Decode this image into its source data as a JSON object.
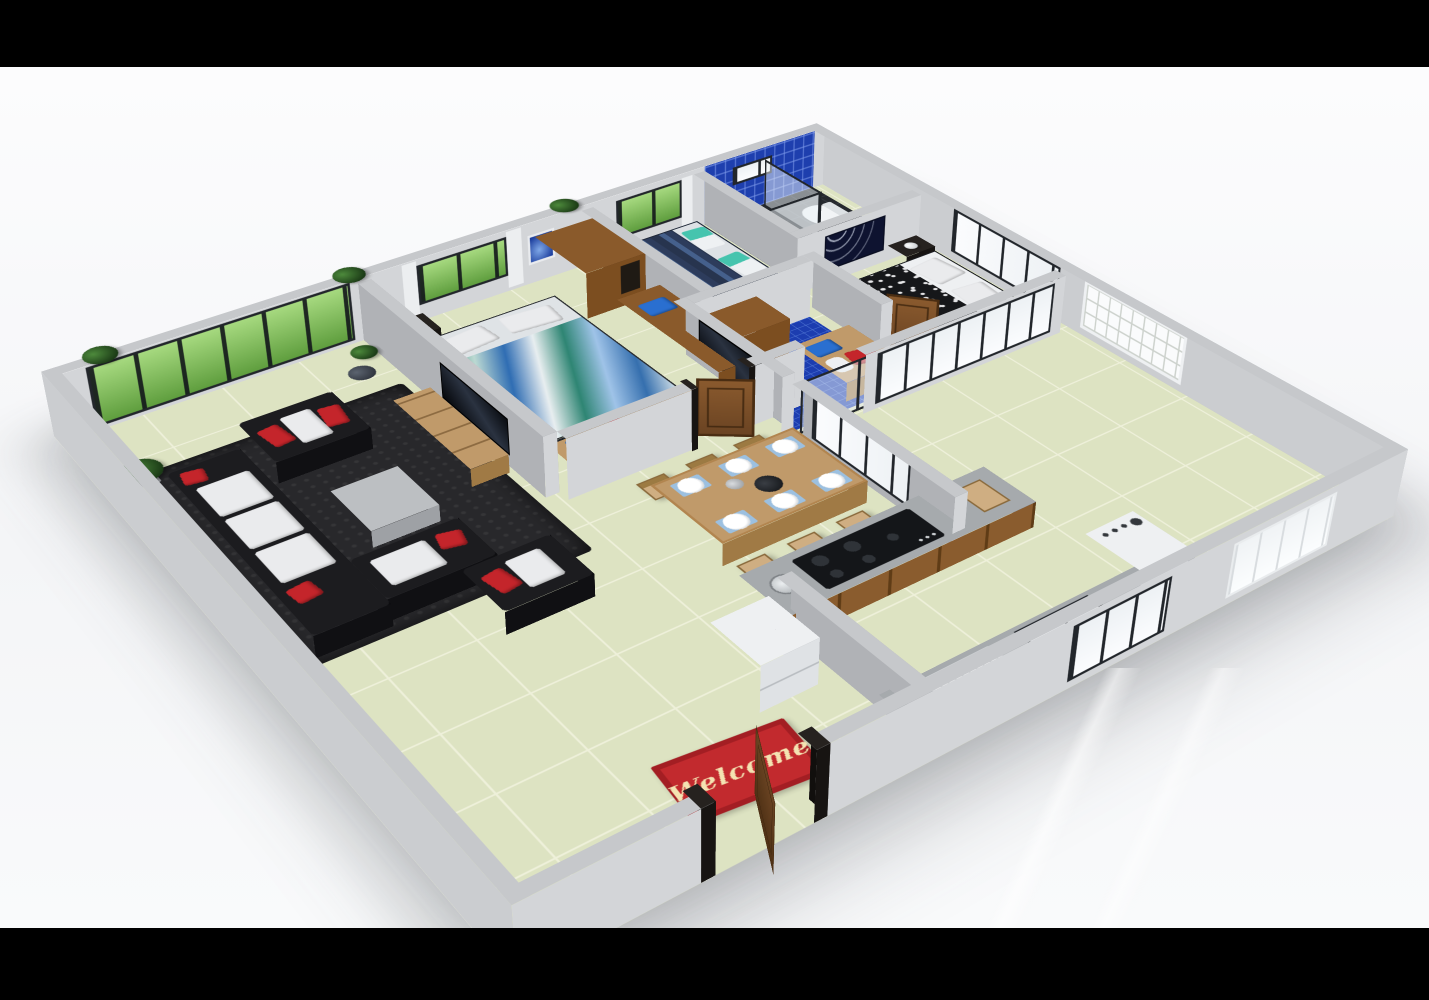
{
  "scene_type": "3d-isometric-floor-plan",
  "entrance": {
    "mat_text": "Welcome"
  },
  "colors": {
    "letterbox": "#000000",
    "wall_cap": "#c6c8cb",
    "wall_face": "#d3d5d8",
    "wall_side": "#b0b2b6",
    "wall_outer": "#cbcdd0",
    "floor_tile": "#dde3c2",
    "floor_grout": "#eef0da",
    "rug": "#28282b",
    "sofa_black": "#1c1c1f",
    "cushion_white": "#eaebed",
    "accent_red": "#c4252b",
    "wood_mid": "#8a5a2b",
    "wood_light": "#c09a6a",
    "wood_pale": "#cfae82",
    "stripe_navy": "#27344e",
    "stripe_blue": "#45608c",
    "bath_blue": "#1e3fae",
    "bath_floor_dark": "#26292e",
    "glass_green_hi": "#a6d97f",
    "glass_green_lo": "#5f9e3e",
    "concrete": "#a6aaad",
    "white_goods": "#eef0f2",
    "mat_red": "#c22a2e",
    "mat_text_color": "#f4e3b2",
    "frame_black": "#22262b"
  },
  "rooms": [
    {
      "name": "living-room",
      "furniture": [
        "sectional-sofa",
        "armchair",
        "accent-chair",
        "coffee-table",
        "area-rug",
        "tv-stand",
        "tv",
        "floor-plants"
      ]
    },
    {
      "name": "master-bedroom",
      "furniture": [
        "double-bed",
        "nightstand",
        "table-lamp",
        "wardrobe",
        "dresser",
        "foot-bench",
        "cushions"
      ]
    },
    {
      "name": "bedroom-2",
      "furniture": [
        "double-bed",
        "pillows"
      ]
    },
    {
      "name": "bathroom-1",
      "furniture": [
        "glass-shower",
        "toilet",
        "bidet",
        "blue-tile-walls"
      ]
    },
    {
      "name": "bedroom-3",
      "furniture": [
        "double-bed",
        "nightstand",
        "table-lamp",
        "tree-wall-art"
      ]
    },
    {
      "name": "bathroom-2",
      "furniture": [
        "toilet",
        "tall-cabinet",
        "bench",
        "sliding-glass-doors",
        "wall-tv"
      ]
    },
    {
      "name": "kitchen-dining",
      "furniture": [
        "dining-table",
        "six-chairs",
        "plates",
        "cooktop",
        "sink",
        "dish-rack",
        "fridge",
        "washing-machine",
        "counters"
      ]
    },
    {
      "name": "entrance",
      "furniture": [
        "front-door",
        "welcome-mat"
      ]
    }
  ]
}
